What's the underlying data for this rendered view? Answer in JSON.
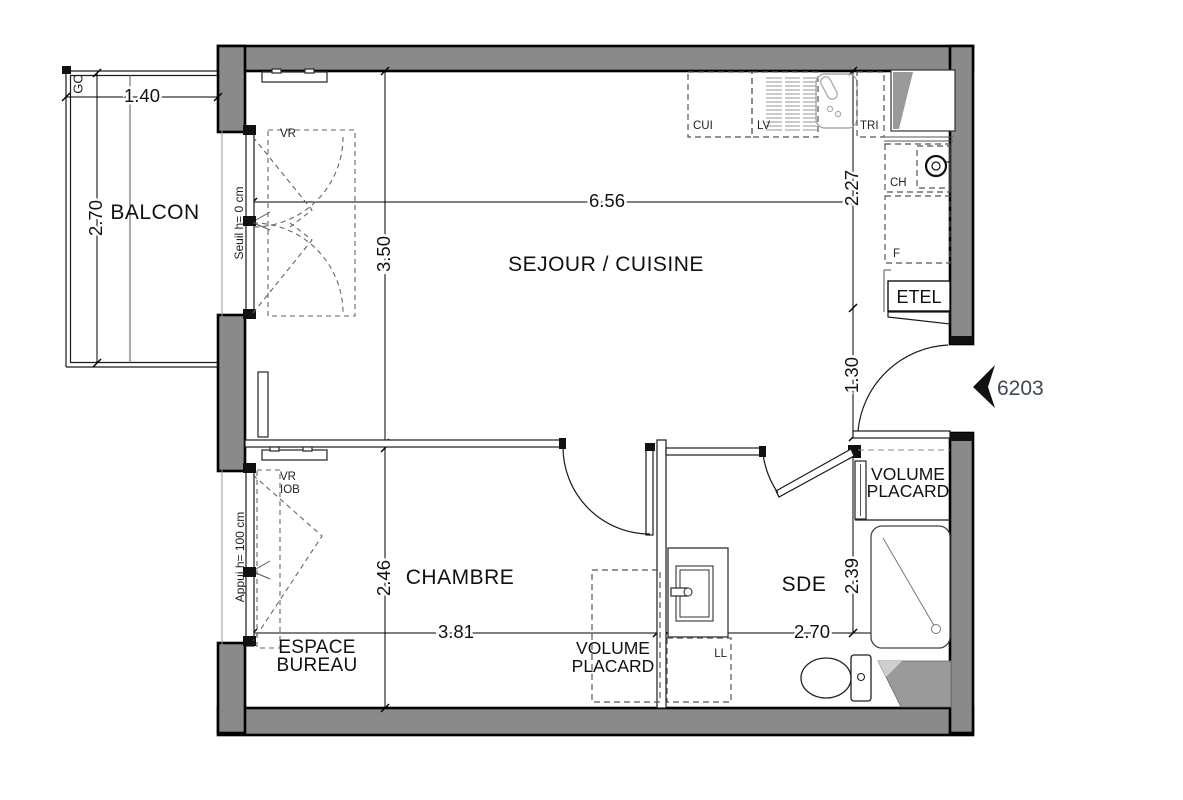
{
  "plan": {
    "unit_number": "6203",
    "rooms": {
      "balcony": "BALCON",
      "living_kitchen": "SEJOUR / CUISINE",
      "bedroom": "CHAMBRE",
      "shower_room": "SDE",
      "office_area": {
        "line1": "ESPACE",
        "line2": "BUREAU"
      },
      "bedroom_closet": {
        "line1": "VOLUME",
        "line2": "PLACARD"
      },
      "entry_closet": {
        "line1": "VOLUME",
        "line2": "PLACARD"
      },
      "electrical_panel": "ETEL"
    },
    "fixtures": {
      "kitchen_unit": "CUI",
      "dishwasher": "LV",
      "waste_sorting": "TRI",
      "water_heater": "CH",
      "fridge": "F",
      "washing_machine": "LL"
    },
    "annotations": {
      "guardrail": "GC",
      "balcony_window_shutter": "VR",
      "balcony_window_sill": "Seuil h=  0 cm",
      "bedroom_window_shutter_line1": "VR",
      "bedroom_window_shutter_line2": "IOB",
      "bedroom_window_sill": "Appui h=  100 cm"
    },
    "dimensions": {
      "balcony_width": "1.40",
      "balcony_depth": "2.70",
      "living_width": "6.56",
      "living_depth": "3.50",
      "kitchen_depth": "2.27",
      "entry_width": "1.30",
      "bedroom_depth": "2.46",
      "bedroom_width": "3.81",
      "shower_room_width": "2.70",
      "shower_room_depth": "2.39"
    }
  }
}
